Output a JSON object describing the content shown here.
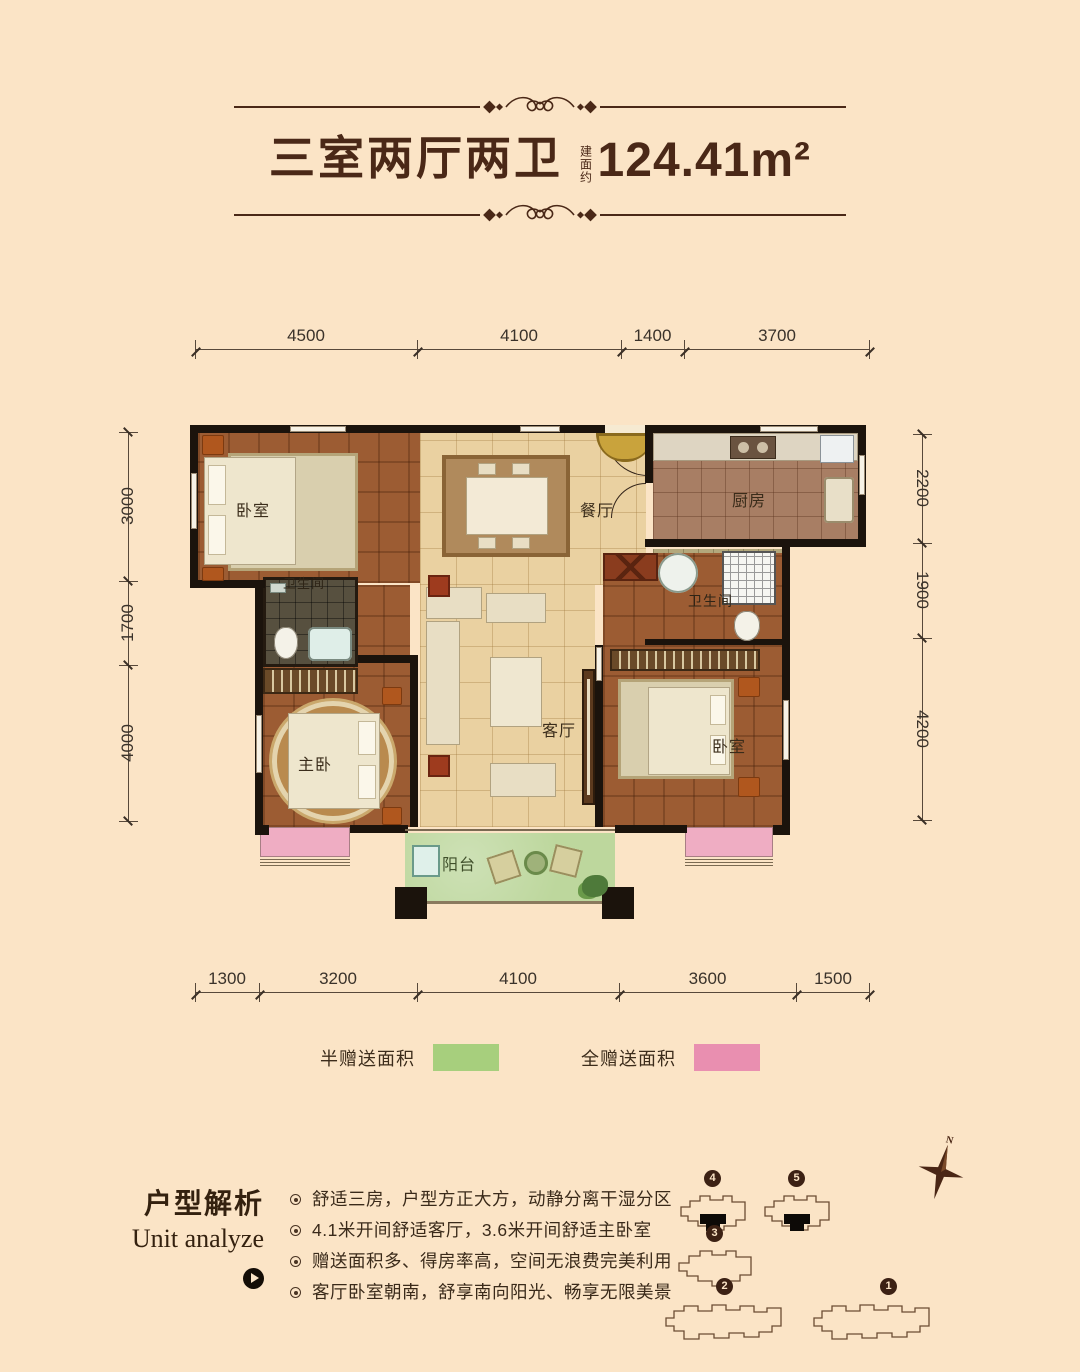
{
  "header": {
    "title": "三室两厅两卫",
    "area_note": "建面约",
    "area_value": "124.41m²"
  },
  "dimensions": {
    "top": [
      "4500",
      "4100",
      "1400",
      "3700"
    ],
    "bottom": [
      "1300",
      "3200",
      "4100",
      "3600",
      "1500"
    ],
    "left": [
      "3000",
      "1700",
      "4000"
    ],
    "right": [
      "2200",
      "1900",
      "4200"
    ]
  },
  "rooms": {
    "bedroom_top_left": "卧室",
    "dining": "餐厅",
    "kitchen": "厨房",
    "bath_small": "卫生间",
    "bath_master": "卫生间",
    "master_bedroom": "主卧",
    "living": "客厅",
    "bedroom_right": "卧室",
    "balcony": "阳台"
  },
  "legend": {
    "half_gift_label": "半赠送面积",
    "half_gift_color": "#a7cf7d",
    "full_gift_label": "全赠送面积",
    "full_gift_color": "#e98fb0"
  },
  "analysis": {
    "title_zh": "户型解析",
    "title_en": "Unit analyze",
    "bullets": [
      "舒适三房，户型方正大方，动静分离干湿分区",
      "4.1米开间舒适客厅，3.6米开间舒适主卧室",
      "赠送面积多、得房率高，空间无浪费完美利用",
      "客厅卧室朝南，舒享南向阳光、畅享无限美景"
    ]
  },
  "site_plan": {
    "compass_label": "N",
    "building_numbers": [
      "4",
      "5",
      "3",
      "2",
      "1"
    ]
  },
  "colors": {
    "background": "#fbe4c6",
    "title_text": "#4a2817",
    "wall": "#1b130c",
    "wood_floor": "#9c5c33",
    "tile_floor": "#ead1a1",
    "balcony_floor": "#bdd79d",
    "gift_half": "#a7cf7d",
    "gift_full": "#e98fb0"
  }
}
